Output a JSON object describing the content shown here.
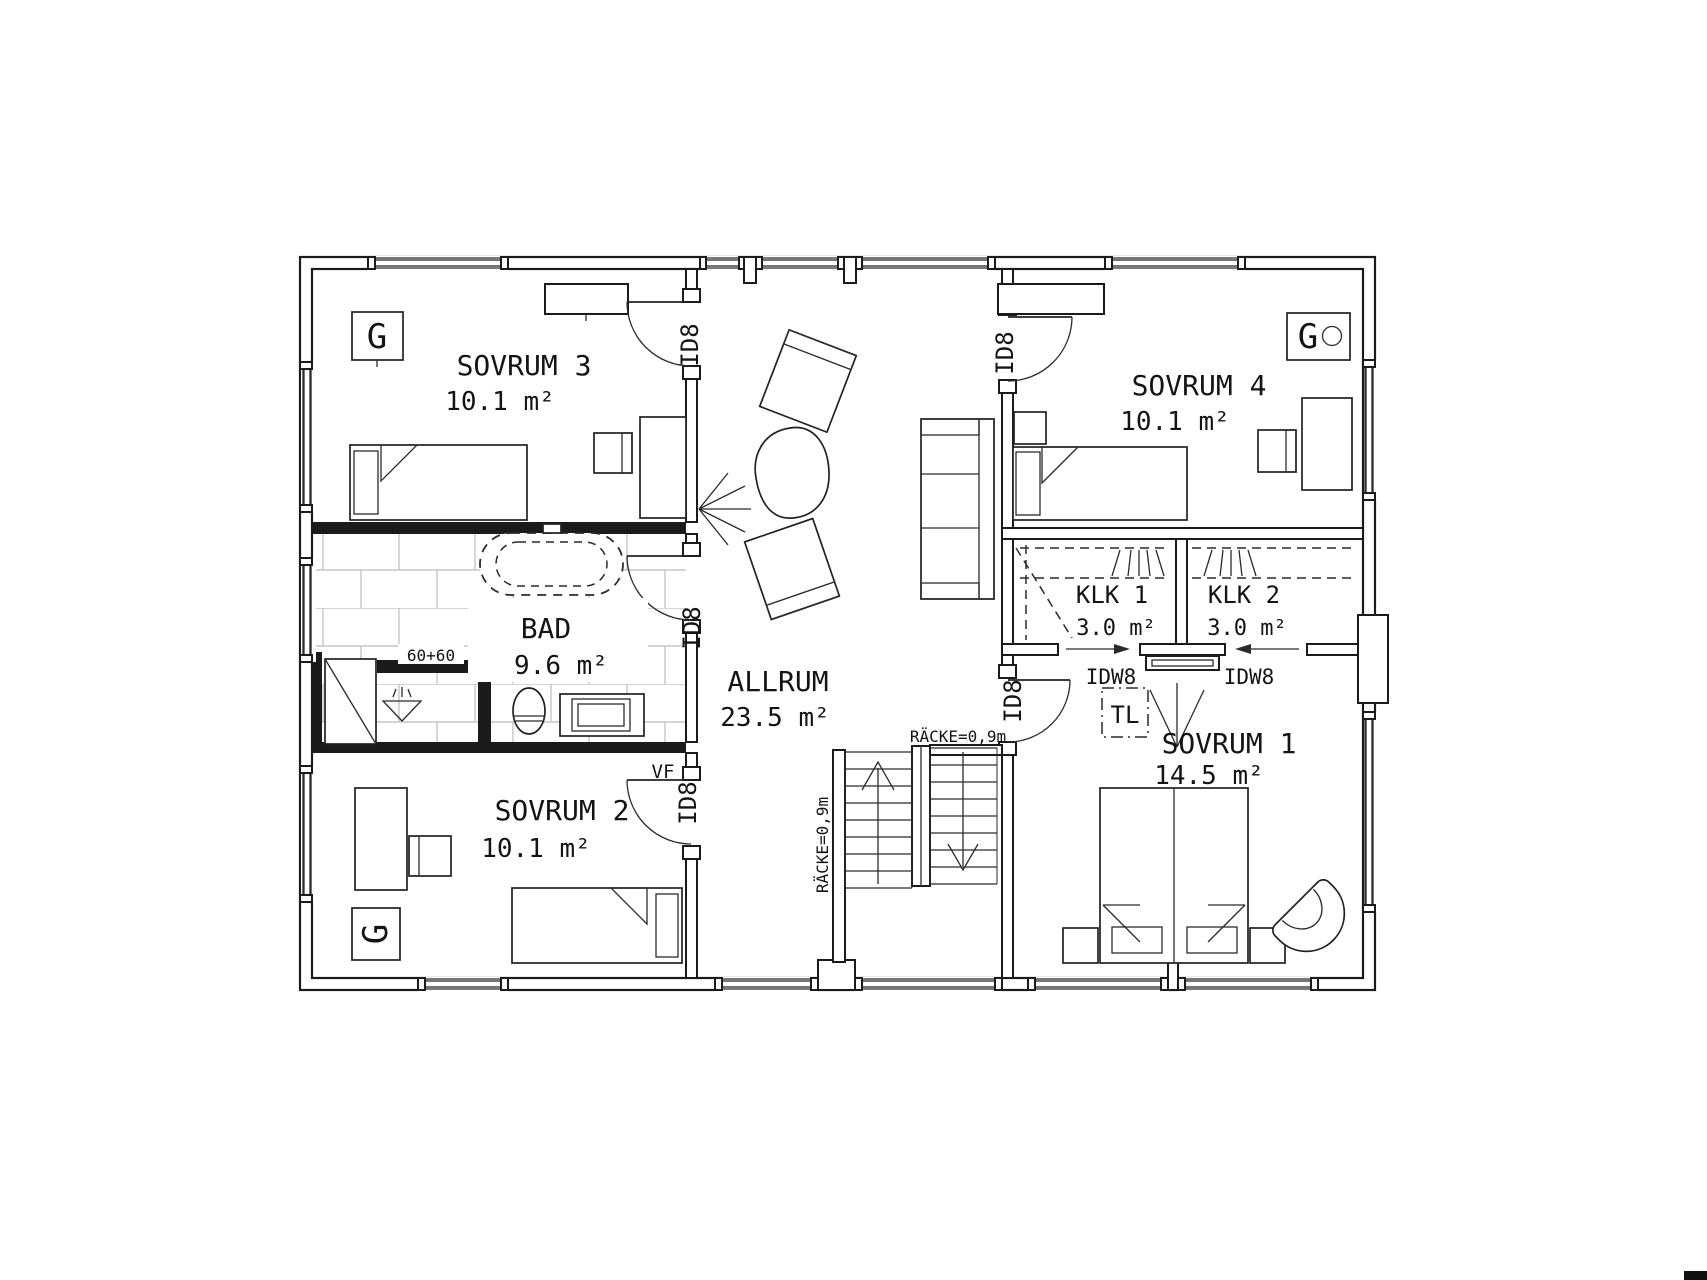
{
  "meta": {
    "drawing_type": "floor-plan",
    "language": "sv",
    "floor": "upper"
  },
  "colors": {
    "line": "#1b1b1b",
    "tile": "#c6c6c6",
    "background": "#ffffff"
  },
  "rooms": [
    {
      "name": "SOVRUM 3",
      "area": "10.1 m²"
    },
    {
      "name": "BAD",
      "area": "9.6 m²"
    },
    {
      "name": "SOVRUM 2",
      "area": "10.1 m²"
    },
    {
      "name": "ALLRUM",
      "area": "23.5 m²"
    },
    {
      "name": "SOVRUM 4",
      "area": "10.1 m²"
    },
    {
      "name": "KLK 1",
      "area": "3.0 m²"
    },
    {
      "name": "KLK 2",
      "area": "3.0 m²"
    },
    {
      "name": "SOVRUM 1",
      "area": "14.5 m²"
    }
  ],
  "labels": {
    "door_interior": "ID8",
    "door_sliding": "IDW8",
    "wardrobe": "G",
    "shower": "60+60",
    "railing": "RÄCKE=0,9m",
    "hatch": "TL",
    "vestibule": "VF"
  }
}
